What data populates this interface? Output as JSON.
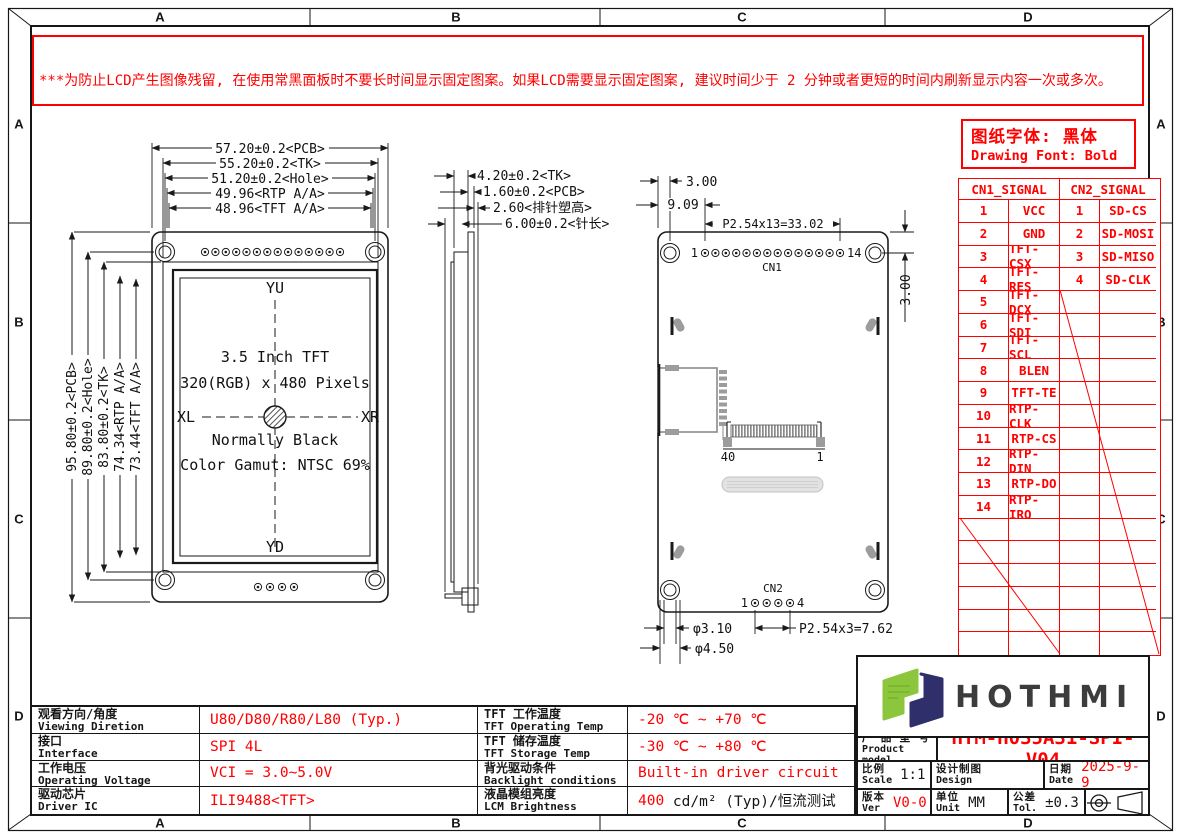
{
  "frame": {
    "cols": [
      "A",
      "B",
      "C",
      "D"
    ],
    "rows": [
      "A",
      "B",
      "C",
      "D"
    ]
  },
  "warning": {
    "lines": [
      "***为防止LCD产生图像残留, 在使用常黑面板时不要长时间显示固定图案。如果LCD需要显示固定图案, 建议时间少于 2 分钟或者更短的时间内刷新显示内容一次或多次。",
      "***In order to prevent the LCD from producing image retention,do not display a fixed pattern for a long time when using a normally black panel.If the",
      " LCD needs to display a fixed pattern,  it is recommended to refresh the display one or more times in less than 2 minutes or less.",
      "强烈建议使用黑色图像或移动图像作为屏幕保护程序。It is strongly recommended to use a black image or moving image as a screen saver."
    ]
  },
  "front_view": {
    "dims_top": [
      "57.20±0.2<PCB>",
      "55.20±0.2<TK>",
      "51.20±0.2<Hole>",
      "49.96<RTP A/A>",
      "48.96<TFT A/A>"
    ],
    "dims_left": [
      "95.80±0.2<PCB>",
      "89.80±0.2<Hole>",
      "83.80±0.2<TK>",
      "74.34<RTP A/A>",
      "73.44<TFT A/A>"
    ],
    "dir_top": "YU",
    "dir_bottom": "YD",
    "dir_left": "XL",
    "dir_right": "XR",
    "center_lines": [
      "3.5 Inch TFT",
      "320(RGB) x 480 Pixels",
      "Normally Black",
      "Color Gamut: NTSC 69%"
    ]
  },
  "side_view": {
    "dims": [
      "4.20±0.2<TK>",
      "1.60±0.2<PCB>",
      "2.60<排针塑高>",
      "6.00±0.2<针长>"
    ]
  },
  "back_view": {
    "dim_edge_to_hole": "3.00",
    "dim_edge_to_pin1": "9.09",
    "dim_cn1_pitch": "P2.54x13=33.02",
    "dim_top_to_pins": "3.00",
    "cn1_label": "CN1",
    "cn1_first": "1",
    "cn1_last": "14",
    "fpc_left": "40",
    "fpc_right": "1",
    "cn2_label": "CN2",
    "cn2_first": "1",
    "cn2_last": "4",
    "dia_inner": "φ3.10",
    "dia_outer": "φ4.50",
    "cn2_pitch": "P2.54x3=7.62"
  },
  "font_note": {
    "cn": "图纸字体: 黑体",
    "en": "Drawing Font: Bold"
  },
  "signal_table": {
    "cn1_header": "CN1_SIGNAL",
    "cn2_header": "CN2_SIGNAL",
    "cn1_pins": [
      [
        "1",
        "VCC"
      ],
      [
        "2",
        "GND"
      ],
      [
        "3",
        "TFT-CSX"
      ],
      [
        "4",
        "TFT-RES"
      ],
      [
        "5",
        "TFT-DCX"
      ],
      [
        "6",
        "TFT-SDI"
      ],
      [
        "7",
        "TFT-SCL"
      ],
      [
        "8",
        "BLEN"
      ],
      [
        "9",
        "TFT-TE"
      ],
      [
        "10",
        "RTP-CLK"
      ],
      [
        "11",
        "RTP-CS"
      ],
      [
        "12",
        "RTP-DIN"
      ],
      [
        "13",
        "RTP-DO"
      ],
      [
        "14",
        "RTP-IRQ"
      ]
    ],
    "cn2_pins": [
      [
        "1",
        "SD-CS"
      ],
      [
        "2",
        "SD-MOSI"
      ],
      [
        "3",
        "SD-MISO"
      ],
      [
        "4",
        "SD-CLK"
      ]
    ]
  },
  "spec_table": {
    "rows": [
      {
        "c1cn": "观看方向/角度",
        "c1en": "Viewing Diretion",
        "v1": "U80/D80/R80/L80 (Typ.)",
        "c2cn": "TFT 工作温度",
        "c2en": "TFT Operating Temp",
        "v2": "-20 ℃ ~ +70 ℃"
      },
      {
        "c1cn": "接口",
        "c1en": "Interface",
        "v1": "SPI 4L",
        "c2cn": "TFT 储存温度",
        "c2en": "TFT Storage Temp",
        "v2": "-30 ℃ ~ +80 ℃"
      },
      {
        "c1cn": "工作电压",
        "c1en": "Operating Voltage",
        "v1": "VCI = 3.0~5.0V",
        "c2cn": "背光驱动条件",
        "c2en": "Backlight conditions",
        "v2": "Built-in driver circuit"
      },
      {
        "c1cn": "驱动芯片",
        "c1en": "Driver IC",
        "v1": "ILI9488<TFT>",
        "c2cn": "液晶模组亮度",
        "c2en": "LCM Brightness",
        "v2a": "400",
        "v2b": " cd/m² (Typ)/恒流测试"
      }
    ]
  },
  "title_block": {
    "brand": "HOTHMI",
    "product_cn": "产 品 型 号",
    "product_en": "Product model",
    "product_value": "HTM-H035A31-SPI-V04",
    "scale_cn": "比例",
    "scale_en": "Scale",
    "scale_value": "1:1",
    "design_cn": "设计制图",
    "design_en": "Design",
    "design_value": "",
    "date_cn": "日期",
    "date_en": "Date",
    "date_value": "2025-9-9",
    "ver_cn": "版本",
    "ver_en": "Ver",
    "ver_value": "V0-0",
    "unit_cn": "单位",
    "unit_en": "Unit",
    "unit_value": "MM",
    "tol_cn": "公差",
    "tol_en": "Tol.",
    "tol_value": "±0.3"
  },
  "colors": {
    "red": "#ff0000",
    "line": "#1a1a1a",
    "logo_green": "#8cc63c",
    "logo_navy": "#2f2f6b"
  }
}
